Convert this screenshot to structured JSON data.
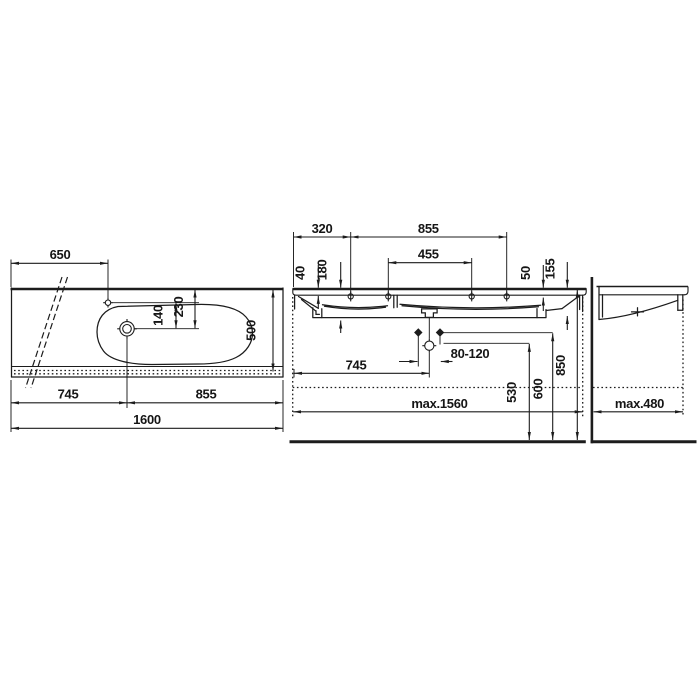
{
  "colors": {
    "line": "#1c1c1c",
    "background": "#ffffff"
  },
  "dims": {
    "plan": {
      "faucet_offset": "650",
      "faucet_to_drain": "140",
      "back_to_drain": "230",
      "depth": "500",
      "left_span": "745",
      "right_span": "855",
      "total_width": "1600"
    },
    "front": {
      "edge_to_hole": "320",
      "hole_span": "855",
      "center_hole_span": "455",
      "ledge_depth_left": "40",
      "bowl_depth_left": "180",
      "ledge_depth_right": "50",
      "bowl_depth_right": "155",
      "drain_offset": "745",
      "bolt_spacing": "80-120",
      "drain_height": "530",
      "bolt_height": "600",
      "rim_height": "850",
      "max_width": "max.1560"
    },
    "side": {
      "max_depth": "max.480"
    }
  }
}
